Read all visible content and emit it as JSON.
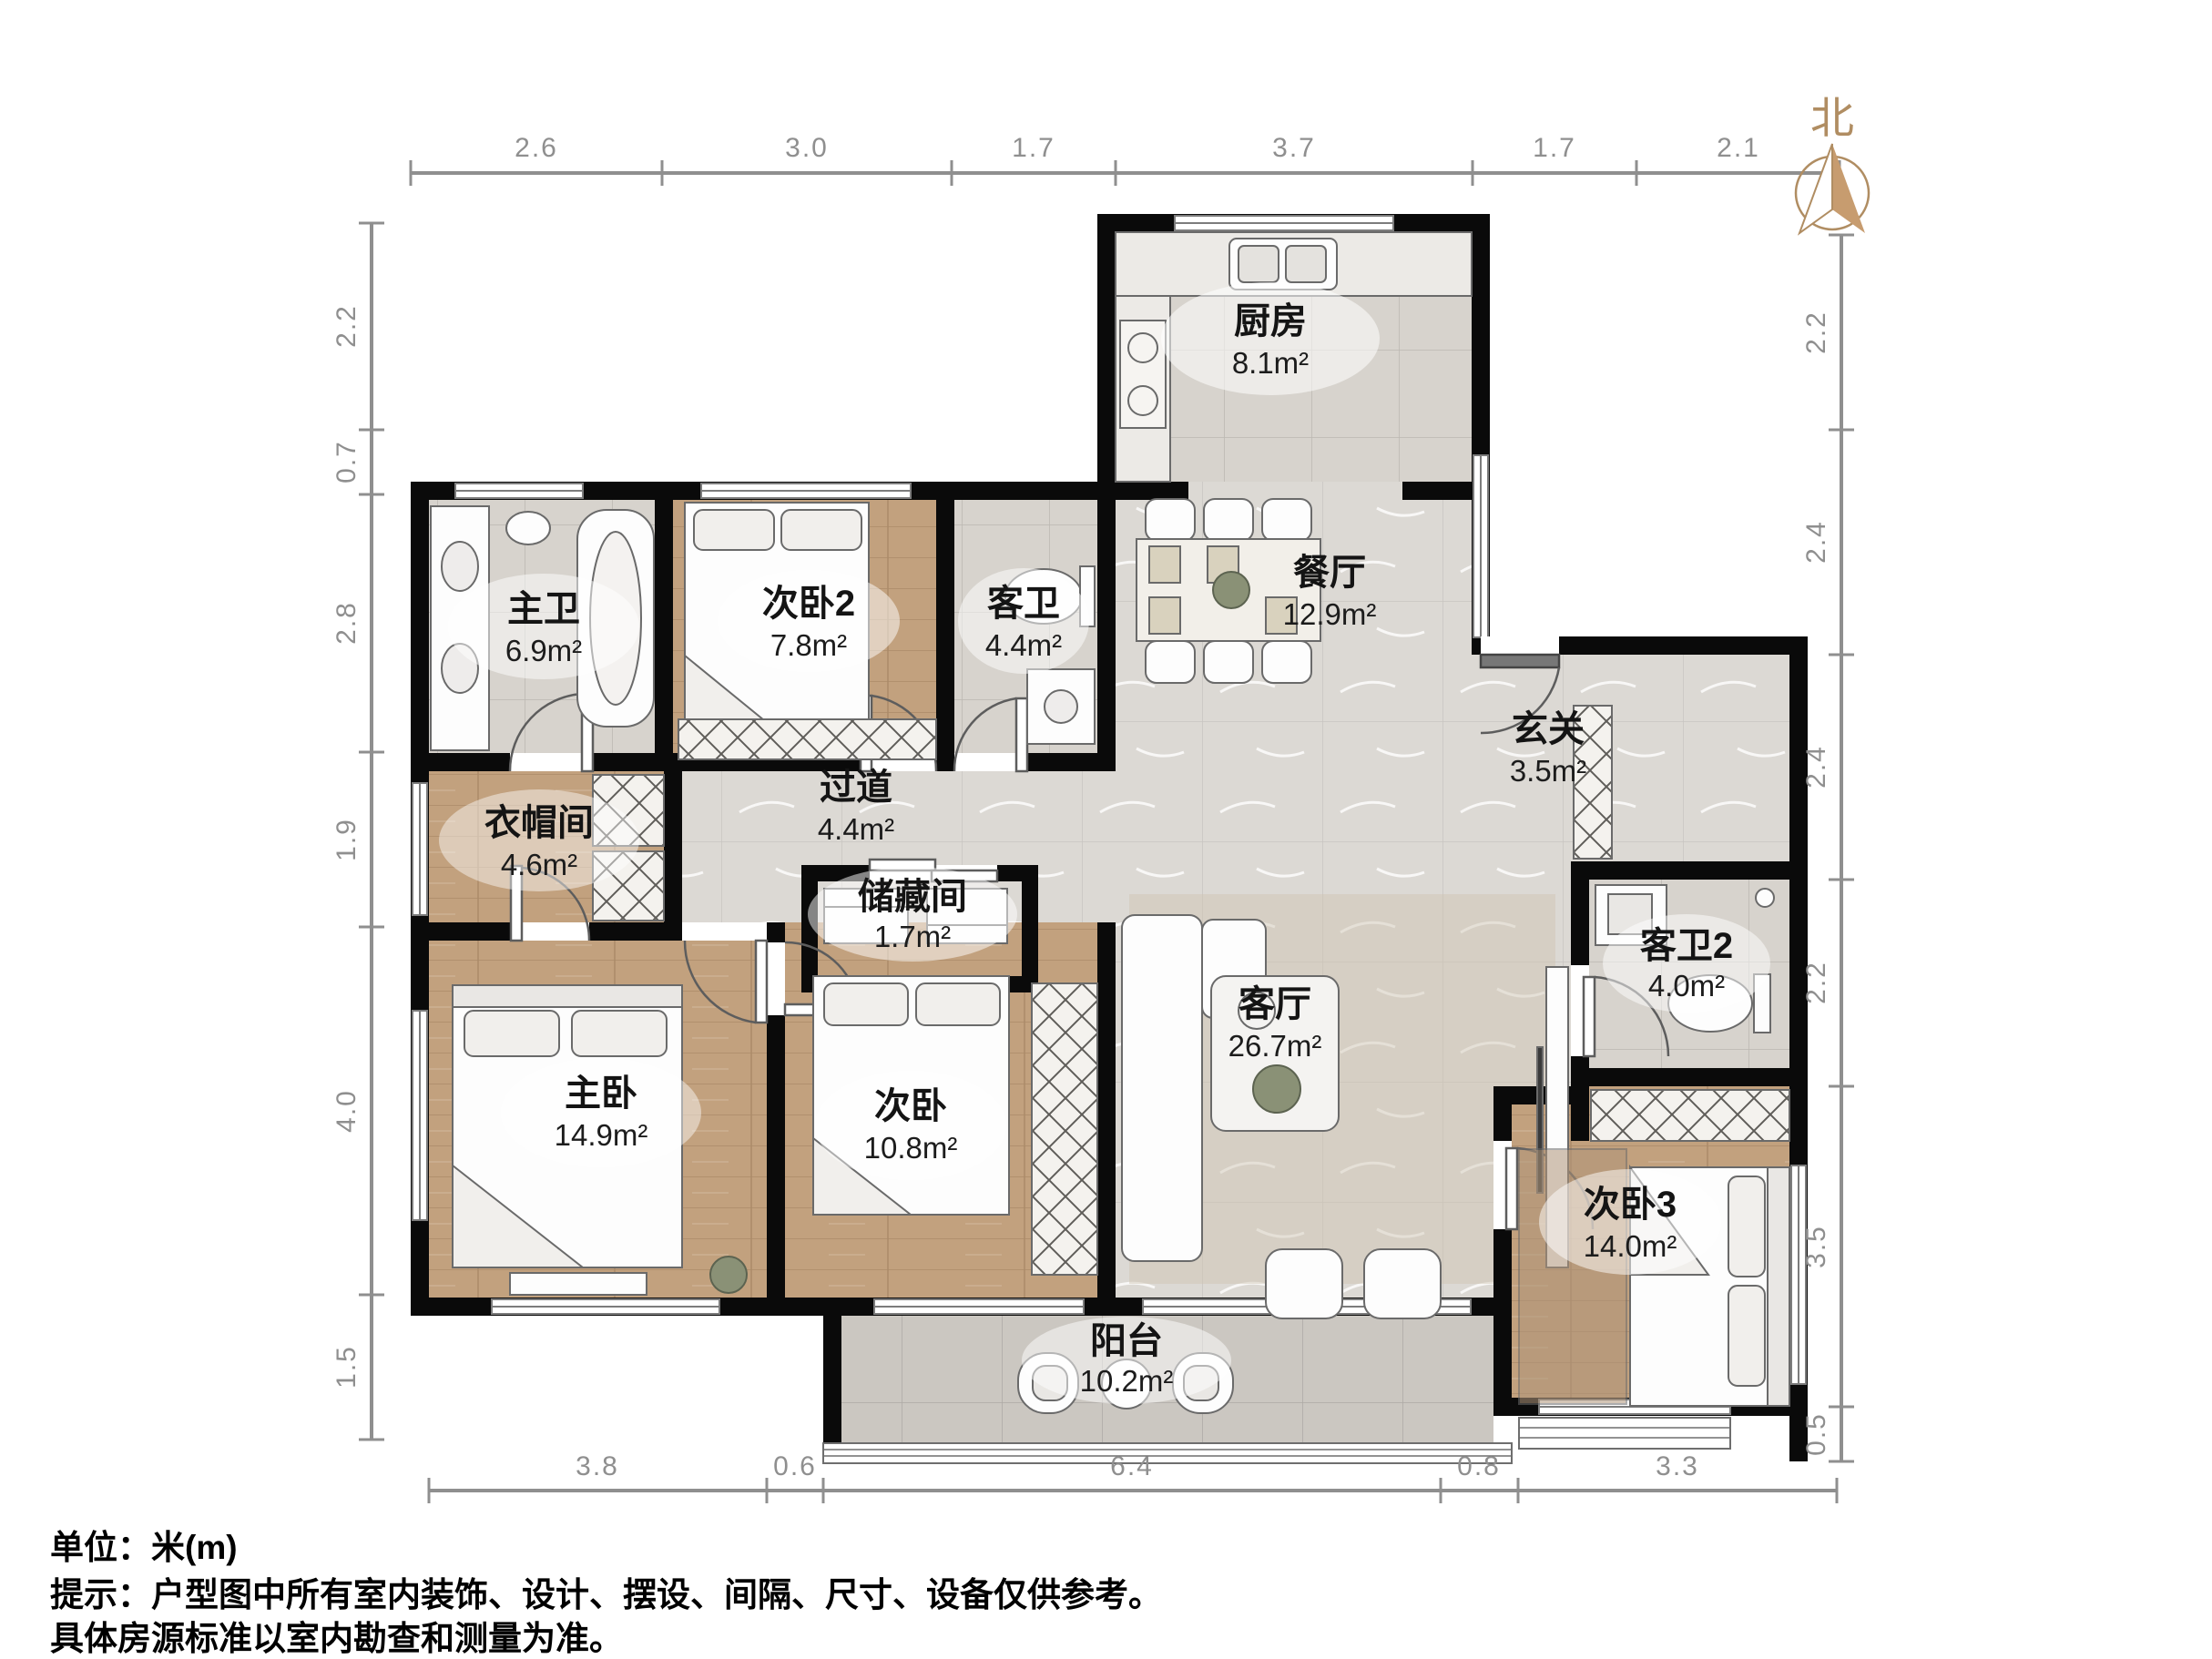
{
  "compass": {
    "label": "北"
  },
  "rooms": [
    {
      "id": "kitchen",
      "name": "厨房",
      "area": "8.1m²"
    },
    {
      "id": "dining",
      "name": "餐厅",
      "area": "12.9m²"
    },
    {
      "id": "master-bath",
      "name": "主卫",
      "area": "6.9m²"
    },
    {
      "id": "bedroom2",
      "name": "次卧2",
      "area": "7.8m²"
    },
    {
      "id": "guest-bath",
      "name": "客卫",
      "area": "4.4m²"
    },
    {
      "id": "entry",
      "name": "玄关",
      "area": "3.5m²"
    },
    {
      "id": "cloakroom",
      "name": "衣帽间",
      "area": "4.6m²"
    },
    {
      "id": "corridor",
      "name": "过道",
      "area": "4.4m²"
    },
    {
      "id": "storage",
      "name": "储藏间",
      "area": "1.7m²"
    },
    {
      "id": "master-bedroom",
      "name": "主卧",
      "area": "14.9m²"
    },
    {
      "id": "bedroom-second",
      "name": "次卧",
      "area": "10.8m²"
    },
    {
      "id": "living",
      "name": "客厅",
      "area": "26.7m²"
    },
    {
      "id": "guest-bath2",
      "name": "客卫2",
      "area": "4.0m²"
    },
    {
      "id": "bedroom3",
      "name": "次卧3",
      "area": "14.0m²"
    },
    {
      "id": "balcony",
      "name": "阳台",
      "area": "10.2m²"
    }
  ],
  "dimensions": {
    "top": [
      "2.6",
      "3.0",
      "1.7",
      "3.7",
      "1.7",
      "2.1"
    ],
    "left": [
      "2.2",
      "0.7",
      "2.8",
      "1.9",
      "4.0",
      "1.5"
    ],
    "right": [
      "2.2",
      "2.4",
      "2.4",
      "2.2",
      "3.5",
      "0.5"
    ],
    "bottom": [
      "3.8",
      "0.6",
      "6.4",
      "0.8",
      "3.3"
    ]
  },
  "footer": {
    "line1": "单位：米(m)",
    "line2": "提示：户型图中所有室内装饰、设计、摆设、间隔、尺寸、设备仅供参考。",
    "line3": "具体房源标准以室内勘查和测量为准。"
  },
  "colors": {
    "wall": "#0a0a0a",
    "wood": "#c2a17e",
    "tile": "#d7d3cd",
    "marble": "#dcd9d4",
    "dim_gray": "#8f8f8f",
    "compass_tan": "#c09468"
  }
}
